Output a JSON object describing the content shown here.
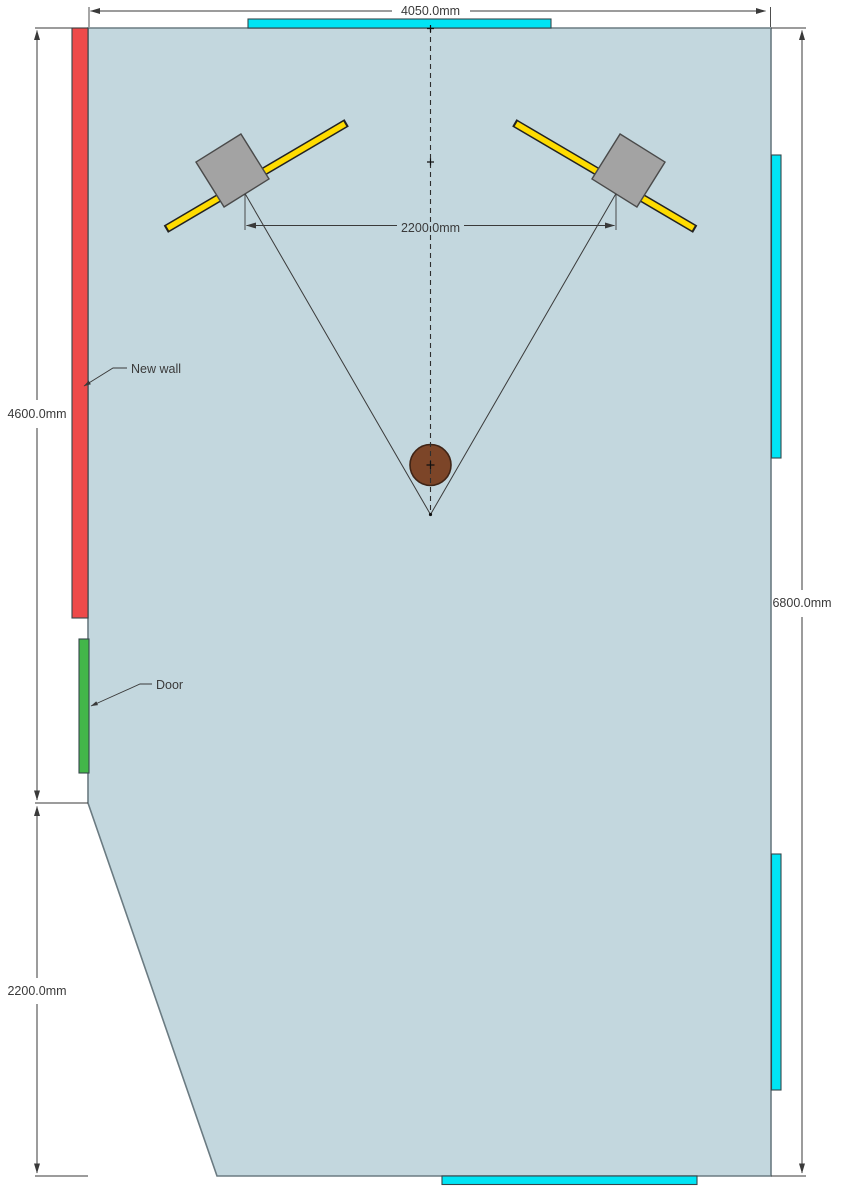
{
  "drawing": {
    "dimensions": {
      "top_width": "4050.0mm",
      "left_wall_height": "4600.0mm",
      "left_lower_height": "2200.0mm",
      "right_wall_height": "6800.0mm",
      "speaker_spacing": "2200.0mm"
    },
    "annotations": {
      "new_wall": "New wall",
      "door": "Door"
    },
    "colors": {
      "room_fill": "#c3d7de",
      "new_wall_fill": "#ee4a4a",
      "door_fill": "#43b649",
      "window_fill": "#00e4f4",
      "speaker_fill": "#a3a3a3",
      "speaker_axis_fill": "#ffdc00",
      "listener_fill": "#7c4528",
      "line_color": "#3a3a3a"
    }
  }
}
